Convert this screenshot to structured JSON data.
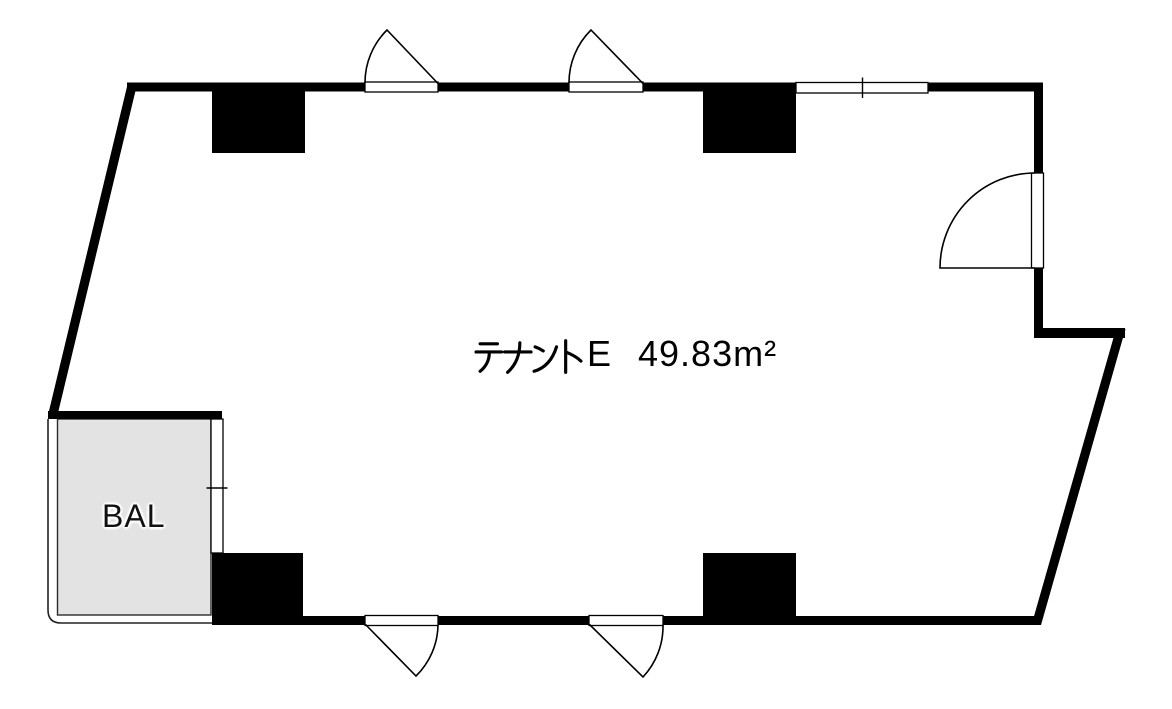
{
  "colors": {
    "wall": "#000000",
    "line": "#000000",
    "background": "#ffffff",
    "balcony_fill": "#e3e3e3"
  },
  "room": {
    "name": "テナントE",
    "name_glyphs": "テナント",
    "name_suffix": "E",
    "area": "49.83m²",
    "full_label": "テナントE　49.83m²"
  },
  "balcony": {
    "label": "BAL"
  }
}
